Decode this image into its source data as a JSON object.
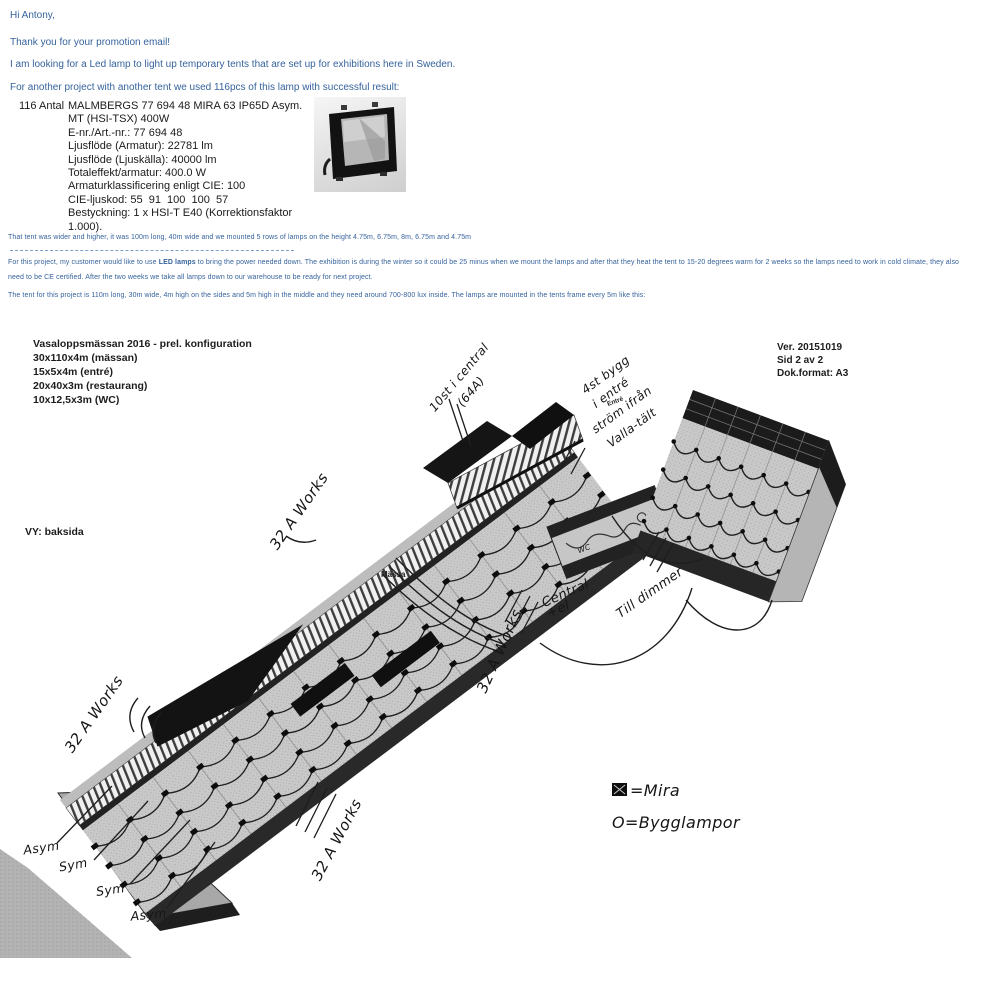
{
  "email": {
    "greeting": "Hi Antony,",
    "thanks": "Thank you for your promotion email!",
    "intro": "I am looking for a Led lamp to light up temporary tents that are set up for exhibitions here in Sweden.",
    "previous": "For another project with another tent we used 116pcs of this lamp with successful result:",
    "spec": {
      "qty": "116 Antal",
      "lines": [
        "MALMBERGS 77 694 48 MIRA 63 IP65D Asym.",
        "MT (HSI-TSX) 400W",
        "E-nr./Art.-nr.: 77 694 48",
        "Ljusflöde (Armatur): 22781 lm",
        "Ljusflöde (Ljuskälla): 40000 lm",
        "Totaleffekt/armatur: 400.0 W",
        "Armaturklassificering enligt CIE: 100",
        "CIE-ljuskod: 55  91  100  100  57",
        "Bestyckning: 1 x HSI-T E40 (Korrektionsfaktor",
        "1.000)."
      ]
    },
    "tent1": "That tent was wider and higher, it was 100m long, 40m wide and we mounted 5 rows of lamps on the height 4.75m, 6.75m, 8m, 6.75m and 4.75m",
    "project": {
      "before": "For this project, my customer would like to use ",
      "bold": "LED lamps",
      "after": " to bring the power needed down. The exhibition is during the winter so it could be 25 minus when we mount the lamps and after that they heat the tent to 15-20 degrees warm for 2 weeks so the lamps need to work in cold climate, they also",
      "line2": "need to be CE certified. After the two weeks we take all lamps down to our warehouse to be ready for next project."
    },
    "tent2": "The tent for this project is 110m long, 30m wide, 4m high on the sides and 5m high in the middle and they need around 700-800 lux inside. The lamps are mounted in the tents frame every 5m like this:"
  },
  "diagram": {
    "title": "Vasaloppsmässan 2016  - prel. konfiguration",
    "config": [
      "30x110x4m (mässan)",
      "15x5x4m (entré)",
      "20x40x3m (restaurang)",
      "10x12,5x3m (WC)"
    ],
    "version": "Ver. 20151019",
    "page": "Sid 2 av 2",
    "format": "Dok.format: A3",
    "view": "VY: baksida",
    "massa": "Mässa",
    "entre": "Entré",
    "annotations": {
      "central1": "10st i central",
      "central2": "(64A)",
      "bygg1": "4st bygg",
      "bygg2": "i entré",
      "bygg3": "ström ifrån",
      "bygg4": "Valla-tält",
      "works": "32 A Works",
      "el1": "Central",
      "el2": "+el",
      "dimmer": "Till dimmer",
      "wc": "WC",
      "asym": "Asym",
      "sym": "Sym"
    },
    "legend": {
      "mira": "=Mira",
      "bygglampor": "O=Bygglampor"
    }
  },
  "colors": {
    "link_blue": "#36639c",
    "tent_grey": "#c9c9c9",
    "ink": "#161616"
  }
}
